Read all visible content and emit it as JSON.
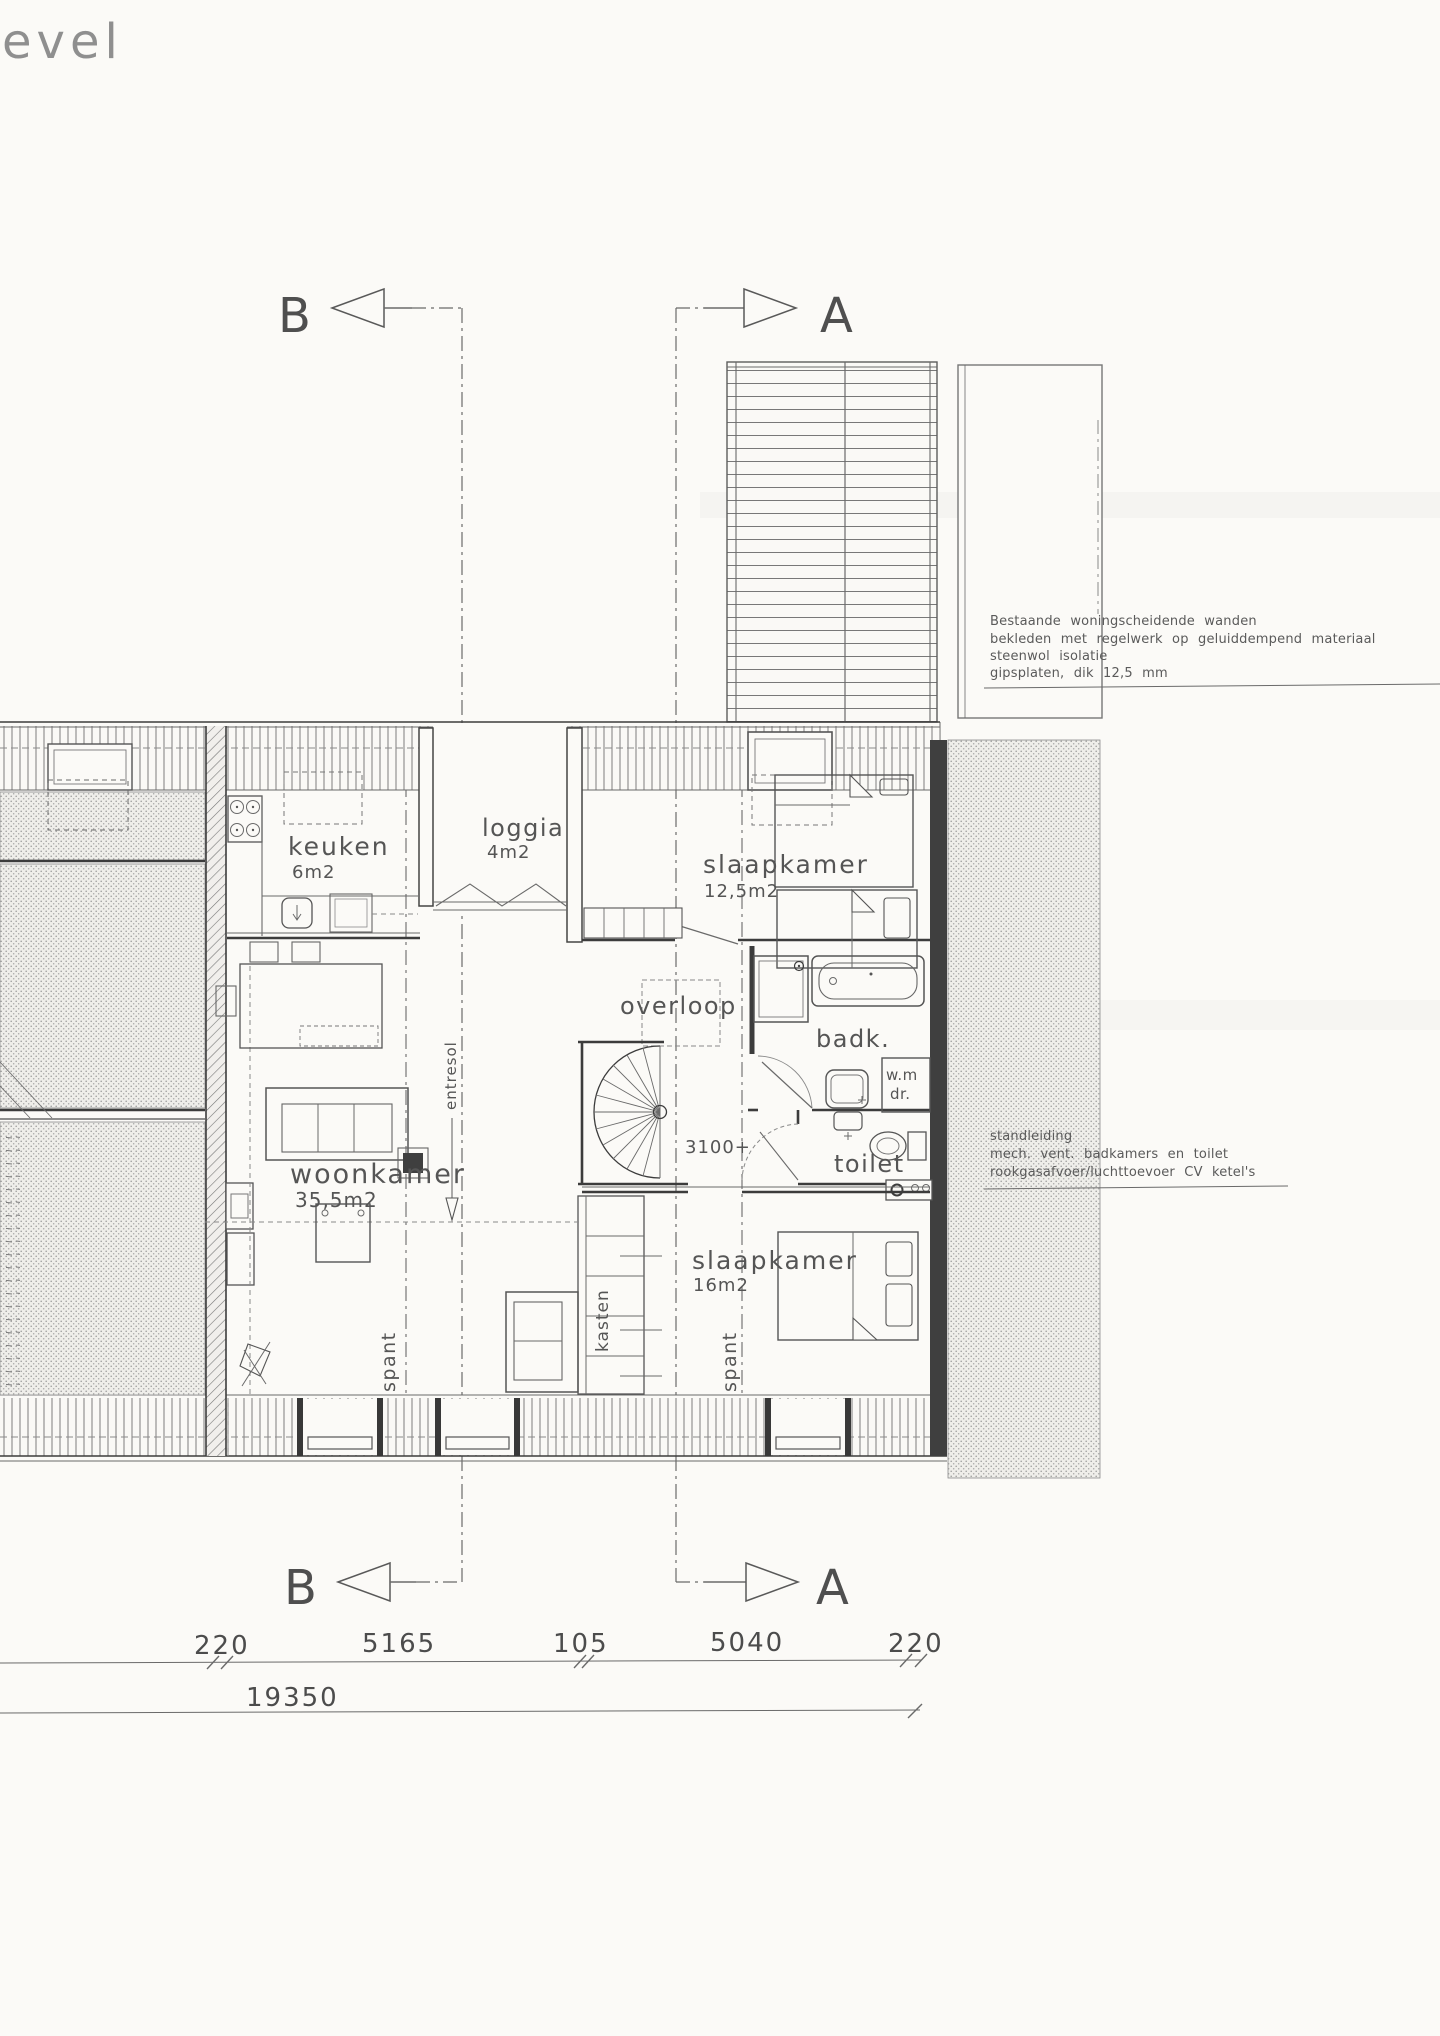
{
  "title": {
    "fragment": "evel"
  },
  "markers": {
    "top_b": "B",
    "top_a": "A",
    "bottom_b": "B",
    "bottom_a": "A"
  },
  "rooms": {
    "keuken": {
      "label": "keuken",
      "area": "6m2"
    },
    "loggia": {
      "label": "loggia",
      "area": "4m2"
    },
    "bedroom1": {
      "label": "slaapkamer",
      "area": "12,5m2"
    },
    "overloop": {
      "label": "overloop"
    },
    "bath": {
      "label": "badk."
    },
    "toilet": {
      "label": "toilet"
    },
    "living": {
      "label": "woonkamer",
      "area": "35,5m2"
    },
    "bedroom2": {
      "label": "slaapkamer",
      "area": "16m2"
    }
  },
  "labels": {
    "kasten": "kasten",
    "spant": "spant",
    "entresol": "entresol",
    "wm": "w.m",
    "dr": "dr.",
    "stair_height": "3100+"
  },
  "notes": {
    "wall": [
      "Bestaande woningscheidende wanden",
      "bekleden met regelwerk op geluiddempend materiaal",
      "steenwol isolatie",
      "gipsplaten, dik 12,5 mm"
    ],
    "services": [
      "standleiding",
      "mech. vent. badkamers en toilet",
      "rookgasafvoer/luchttoevoer CV ketel's"
    ]
  },
  "dims": {
    "segments": [
      "220",
      "5165",
      "105",
      "5040",
      "220"
    ],
    "total": "19350"
  },
  "colors": {
    "ink": "#4f4f4f",
    "wall": "#3c3c3c",
    "paper": "#fbfaf7",
    "stipple": "#9a9a9a"
  }
}
